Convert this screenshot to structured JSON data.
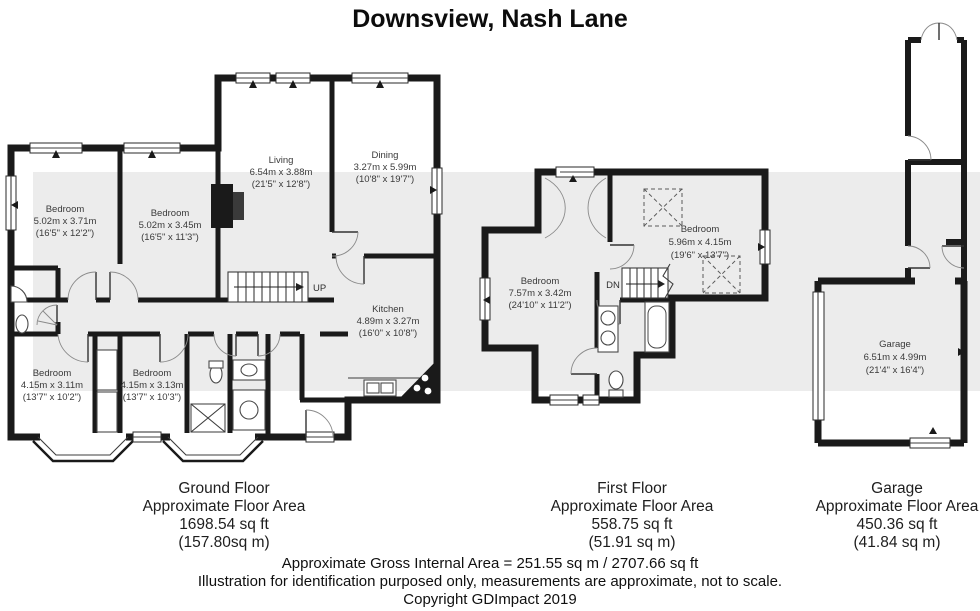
{
  "title": "Downsview, Nash Lane",
  "palette": {
    "wall": "#1a1a1a",
    "band": "#ececec",
    "fixture_line": "#4a4a4a",
    "label_text": "#3a3a3a"
  },
  "floors": {
    "ground": {
      "stairs_label": "UP",
      "rooms": [
        {
          "name": "Bedroom",
          "metric": "5.02m x 3.71m",
          "imperial": "(16'5\" x 12'2\")"
        },
        {
          "name": "Bedroom",
          "metric": "5.02m x 3.45m",
          "imperial": "(16'5\" x 11'3\")"
        },
        {
          "name": "Living",
          "metric": "6.54m x 3.88m",
          "imperial": "(21'5\" x 12'8\")"
        },
        {
          "name": "Dining",
          "metric": "3.27m x 5.99m",
          "imperial": "(10'8\" x 19'7\")"
        },
        {
          "name": "Kitchen",
          "metric": "4.89m x 3.27m",
          "imperial": "(16'0\" x 10'8\")"
        },
        {
          "name": "Bedroom",
          "metric": "4.15m x 3.11m",
          "imperial": "(13'7\" x 10'2\")"
        },
        {
          "name": "Bedroom",
          "metric": "4.15m x 3.13m",
          "imperial": "(13'7\" x 10'3\")"
        }
      ],
      "summary": {
        "title": "Ground Floor",
        "subtitle": "Approximate Floor Area",
        "area_ft": "1698.54 sq ft",
        "area_m": "(157.80sq m)"
      }
    },
    "first": {
      "stairs_label": "DN",
      "rooms": [
        {
          "name": "Bedroom",
          "metric": "7.57m x 3.42m",
          "imperial": "(24'10\" x 11'2\")"
        },
        {
          "name": "Bedroom",
          "metric": "5.96m x 4.15m",
          "imperial": "(19'6\" x 13'7\")"
        }
      ],
      "summary": {
        "title": "First Floor",
        "subtitle": "Approximate Floor Area",
        "area_ft": "558.75 sq ft",
        "area_m": "(51.91 sq m)"
      }
    },
    "garage": {
      "rooms": [
        {
          "name": "Garage",
          "metric": "6.51m x 4.99m",
          "imperial": "(21'4\" x 16'4\")"
        }
      ],
      "summary": {
        "title": "Garage",
        "subtitle": "Approximate Floor Area",
        "area_ft": "450.36 sq ft",
        "area_m": "(41.84 sq m)"
      }
    }
  },
  "footer": {
    "gross_area": "Approximate Gross Internal Area = 251.55 sq m / 2707.66 sq ft",
    "disclaimer": "Illustration for identification purposed only, measurements are approximate, not to scale.",
    "copyright": "Copyright GDImpact 2019"
  }
}
